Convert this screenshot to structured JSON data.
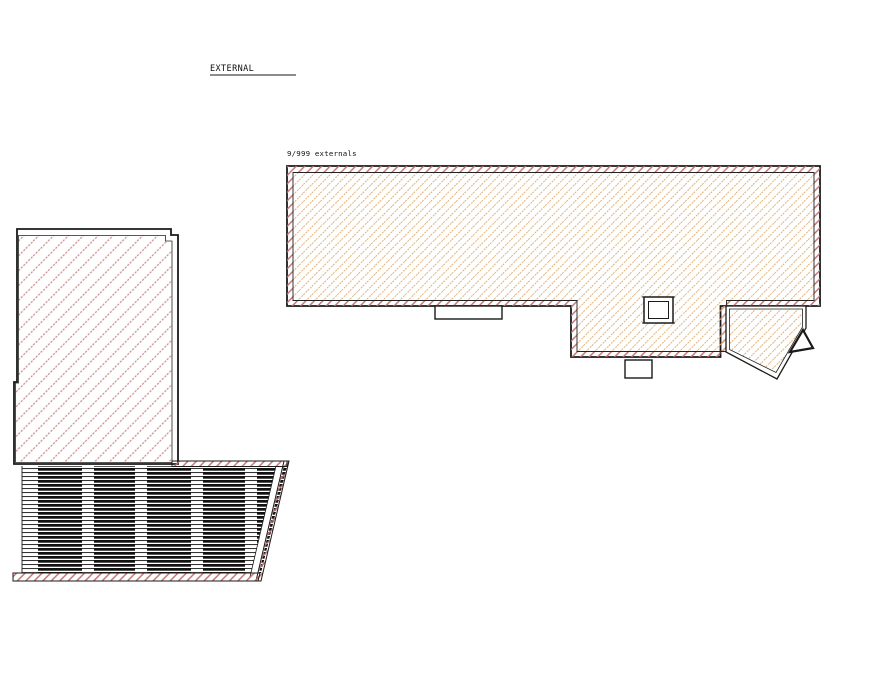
{
  "drawing": {
    "labels": {
      "title": "EXTERNAL",
      "externals": "9/999 externals"
    },
    "colors": {
      "line": "#1a1a1a",
      "tan_hatch": "#dfb279",
      "red_hatch": "#c26c6c",
      "pink_hatch": "#c98f8f",
      "stripe_dark": "#111111",
      "background": "#ffffff"
    }
  }
}
